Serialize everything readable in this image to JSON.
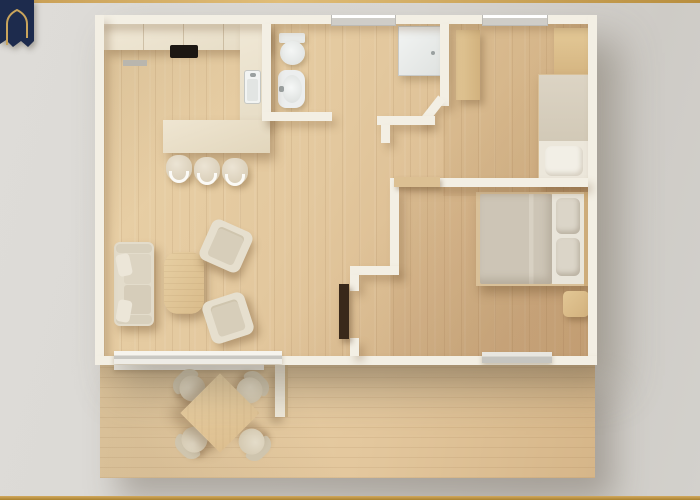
{
  "meta": {
    "content_type": "architectural-floor-plan-render",
    "view": "top-down",
    "visible_text": "none"
  },
  "brand": {
    "logo_icon": "navy-arch-house-logo",
    "logo_bg": "#1d2b4d",
    "logo_outline": "#c9a45c"
  },
  "frame": {
    "top_rule_color": "#c9a152",
    "bottom_rule_color": "#b8923f"
  },
  "colors": {
    "bg": "#d9d7d3",
    "wall": "#f3efe4",
    "wood": "#e3c89e",
    "deck": "#e3c79d",
    "cream": "#ece3cf",
    "tan": "#dcc093",
    "fixture": "#edf0ef",
    "cooktop": "#1c1713",
    "duvet": "#cfc7b8",
    "navy": "#1d2b4d",
    "gold": "#c9a152"
  },
  "floorplan": {
    "rooms": [
      {
        "id": "kitchen",
        "position": "top-left",
        "furniture": [
          "l-shaped-counter",
          "cooktop",
          "sink",
          "kitchen-island",
          "bar-stool",
          "bar-stool",
          "bar-stool",
          "wall-vent"
        ]
      },
      {
        "id": "bathroom",
        "position": "top-center",
        "furniture": [
          "toilet",
          "pedestal-sink",
          "shower-tray"
        ]
      },
      {
        "id": "bedroom-small",
        "position": "top-right",
        "furniture": [
          "wardrobe",
          "corner-cabinet",
          "single-bed",
          "pillow"
        ]
      },
      {
        "id": "bedroom-master",
        "position": "right",
        "furniture": [
          "double-bed",
          "pillow",
          "pillow",
          "nightstand",
          "swing-door-open"
        ]
      },
      {
        "id": "living-room",
        "position": "bottom-left",
        "furniture": [
          "sofa",
          "two-throw-pillows",
          "coffee-table",
          "armchair",
          "armchair"
        ]
      },
      {
        "id": "deck",
        "position": "bottom",
        "furniture": [
          "square-dining-table",
          "round-chair",
          "round-chair",
          "round-chair",
          "round-chair",
          "privacy-screen"
        ]
      }
    ],
    "openings": {
      "top_wall_windows": 2,
      "sliding_doors": [
        "living-room-to-deck",
        "master-bedroom-to-deck",
        "bedroom-divider-pocket-door"
      ],
      "interior_door_openings": [
        "bathroom",
        "bedroom-small",
        "bedroom-master"
      ]
    }
  }
}
